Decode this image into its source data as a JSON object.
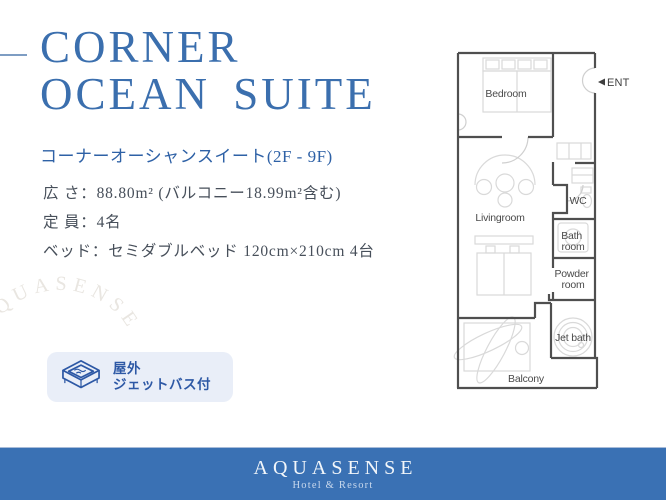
{
  "colors": {
    "accent_blue": "#3b6fae",
    "subtitle_blue": "#2e61a6",
    "text_dark": "#474f5a",
    "dash_color": "#7e9dc3",
    "badge_bg": "#e9eef8",
    "badge_blue": "#2d58a5",
    "footer_blue": "#3a71b4",
    "plan_wall": "#4f4f4f",
    "plan_light": "#d9d9d9",
    "plan_label": "#4a4a4a",
    "watermark_color": "#e9e6e1"
  },
  "title": {
    "line1": "CORNER",
    "line2": "OCEAN SUITE"
  },
  "subtitle": "コーナーオーシャンスイート(2F - 9F)",
  "details": {
    "rows": [
      {
        "text": "広 さ：88.80m² (バルコニー18.99m²含む)"
      },
      {
        "text": "定 員：4名"
      },
      {
        "text": "ベッド：セミダブルベッド 120cm×210cm 4台"
      }
    ]
  },
  "badge": {
    "icon": "jet-bath-icon",
    "line1": "屋外",
    "line2": "ジェットバス付"
  },
  "watermark": {
    "text": "AQUASENSE"
  },
  "floorplan": {
    "rooms": {
      "bedroom": "Bedroom",
      "livingroom": "Livingroom",
      "wc": "WC",
      "bath_line1": "Bath",
      "bath_line2": "room",
      "powder_line1": "Powder",
      "powder_line2": "room",
      "jetbath": "Jet bath",
      "balcony": "Balcony"
    },
    "entrance": "ENT"
  },
  "footer": {
    "brand": "AQUASENSE",
    "tagline": "Hotel & Resort"
  }
}
